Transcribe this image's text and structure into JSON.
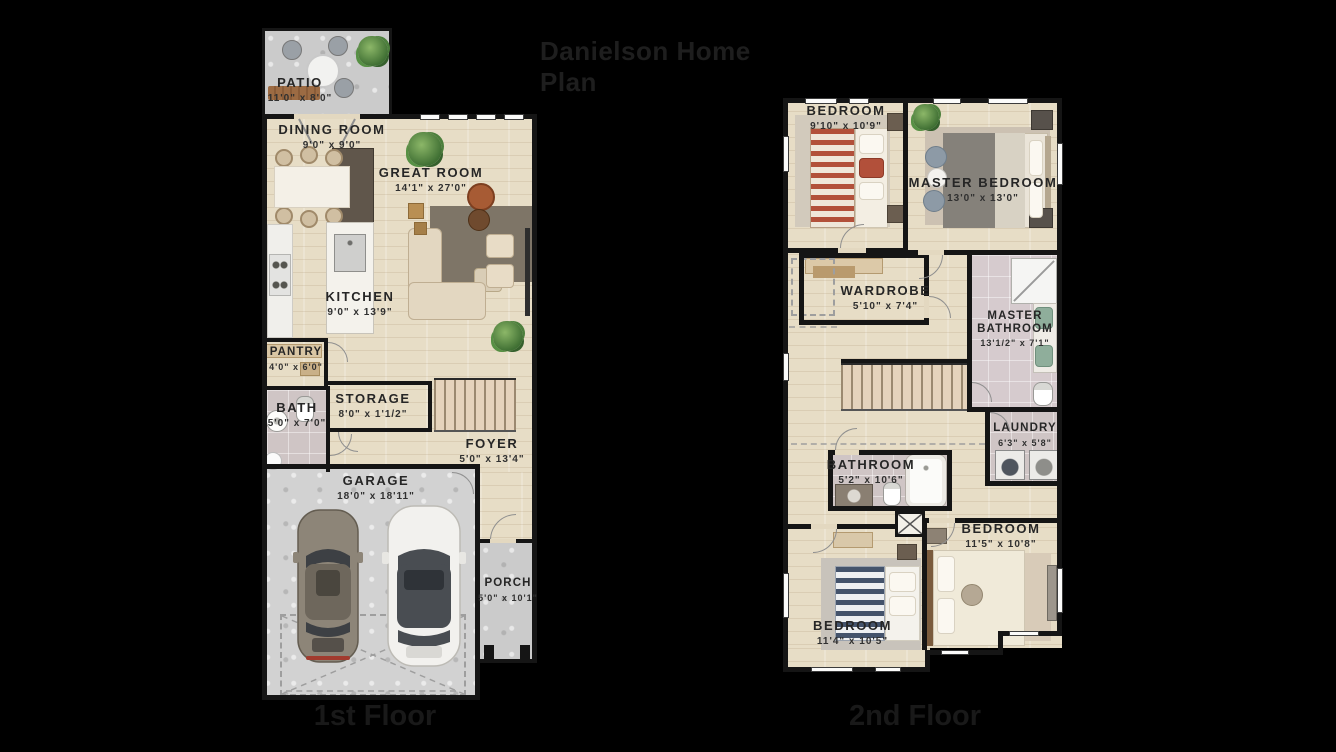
{
  "title": "Danielson Home Plan",
  "colors": {
    "background": "#000000",
    "wood_floor": "#e7ddc6",
    "concrete": "#cbcbcb",
    "tile": "#cfc5c5",
    "wall": "#151515",
    "label_text": "#262626",
    "accent_rug": "#7e7567",
    "accent_rust": "#a75b34"
  },
  "floor1": {
    "label": "1st Floor",
    "rooms": {
      "patio": {
        "name": "PATIO",
        "dims": "11'0\" x 8'0\""
      },
      "dining_room": {
        "name": "DINING ROOM",
        "dims": "9'0\" x 9'0\""
      },
      "great_room": {
        "name": "GREAT ROOM",
        "dims": "14'1\" x 27'0\""
      },
      "kitchen": {
        "name": "KITCHEN",
        "dims": "9'0\" x 13'9\""
      },
      "pantry": {
        "name": "PANTRY",
        "dims": "4'0\" x 6'0\""
      },
      "bath": {
        "name": "BATH",
        "dims": "5'0\" x 7'0\""
      },
      "storage": {
        "name": "STORAGE",
        "dims": "8'0\" x 1'1/2\""
      },
      "foyer": {
        "name": "FOYER",
        "dims": "5'0\" x 13'4\""
      },
      "garage": {
        "name": "GARAGE",
        "dims": "18'0\" x 18'11\""
      },
      "porch": {
        "name": "PORCH",
        "dims": "5'0\" x 10'1\""
      }
    }
  },
  "floor2": {
    "label": "2nd Floor",
    "rooms": {
      "bedroom_1": {
        "name": "BEDROOM",
        "dims": "9'10\" x 10'9\""
      },
      "master_bedroom": {
        "name": "MASTER BEDROOM",
        "dims": "13'0\" x 13'0\""
      },
      "wardrobe": {
        "name": "WARDROBE",
        "dims": "5'10\" x 7'4\""
      },
      "master_bathroom": {
        "name": "MASTER BATHROOM",
        "dims": "13'1/2\" x 7'1\""
      },
      "laundry": {
        "name": "LAUNDRY",
        "dims": "6'3\" x 5'8\""
      },
      "bathroom": {
        "name": "BATHROOM",
        "dims": "5'2\" x 10'6\""
      },
      "bedroom_2": {
        "name": "BEDROOM",
        "dims": "11'5\" x 10'8\""
      },
      "bedroom_3": {
        "name": "BEDROOM",
        "dims": "11'4\" x 10'5\""
      }
    }
  }
}
